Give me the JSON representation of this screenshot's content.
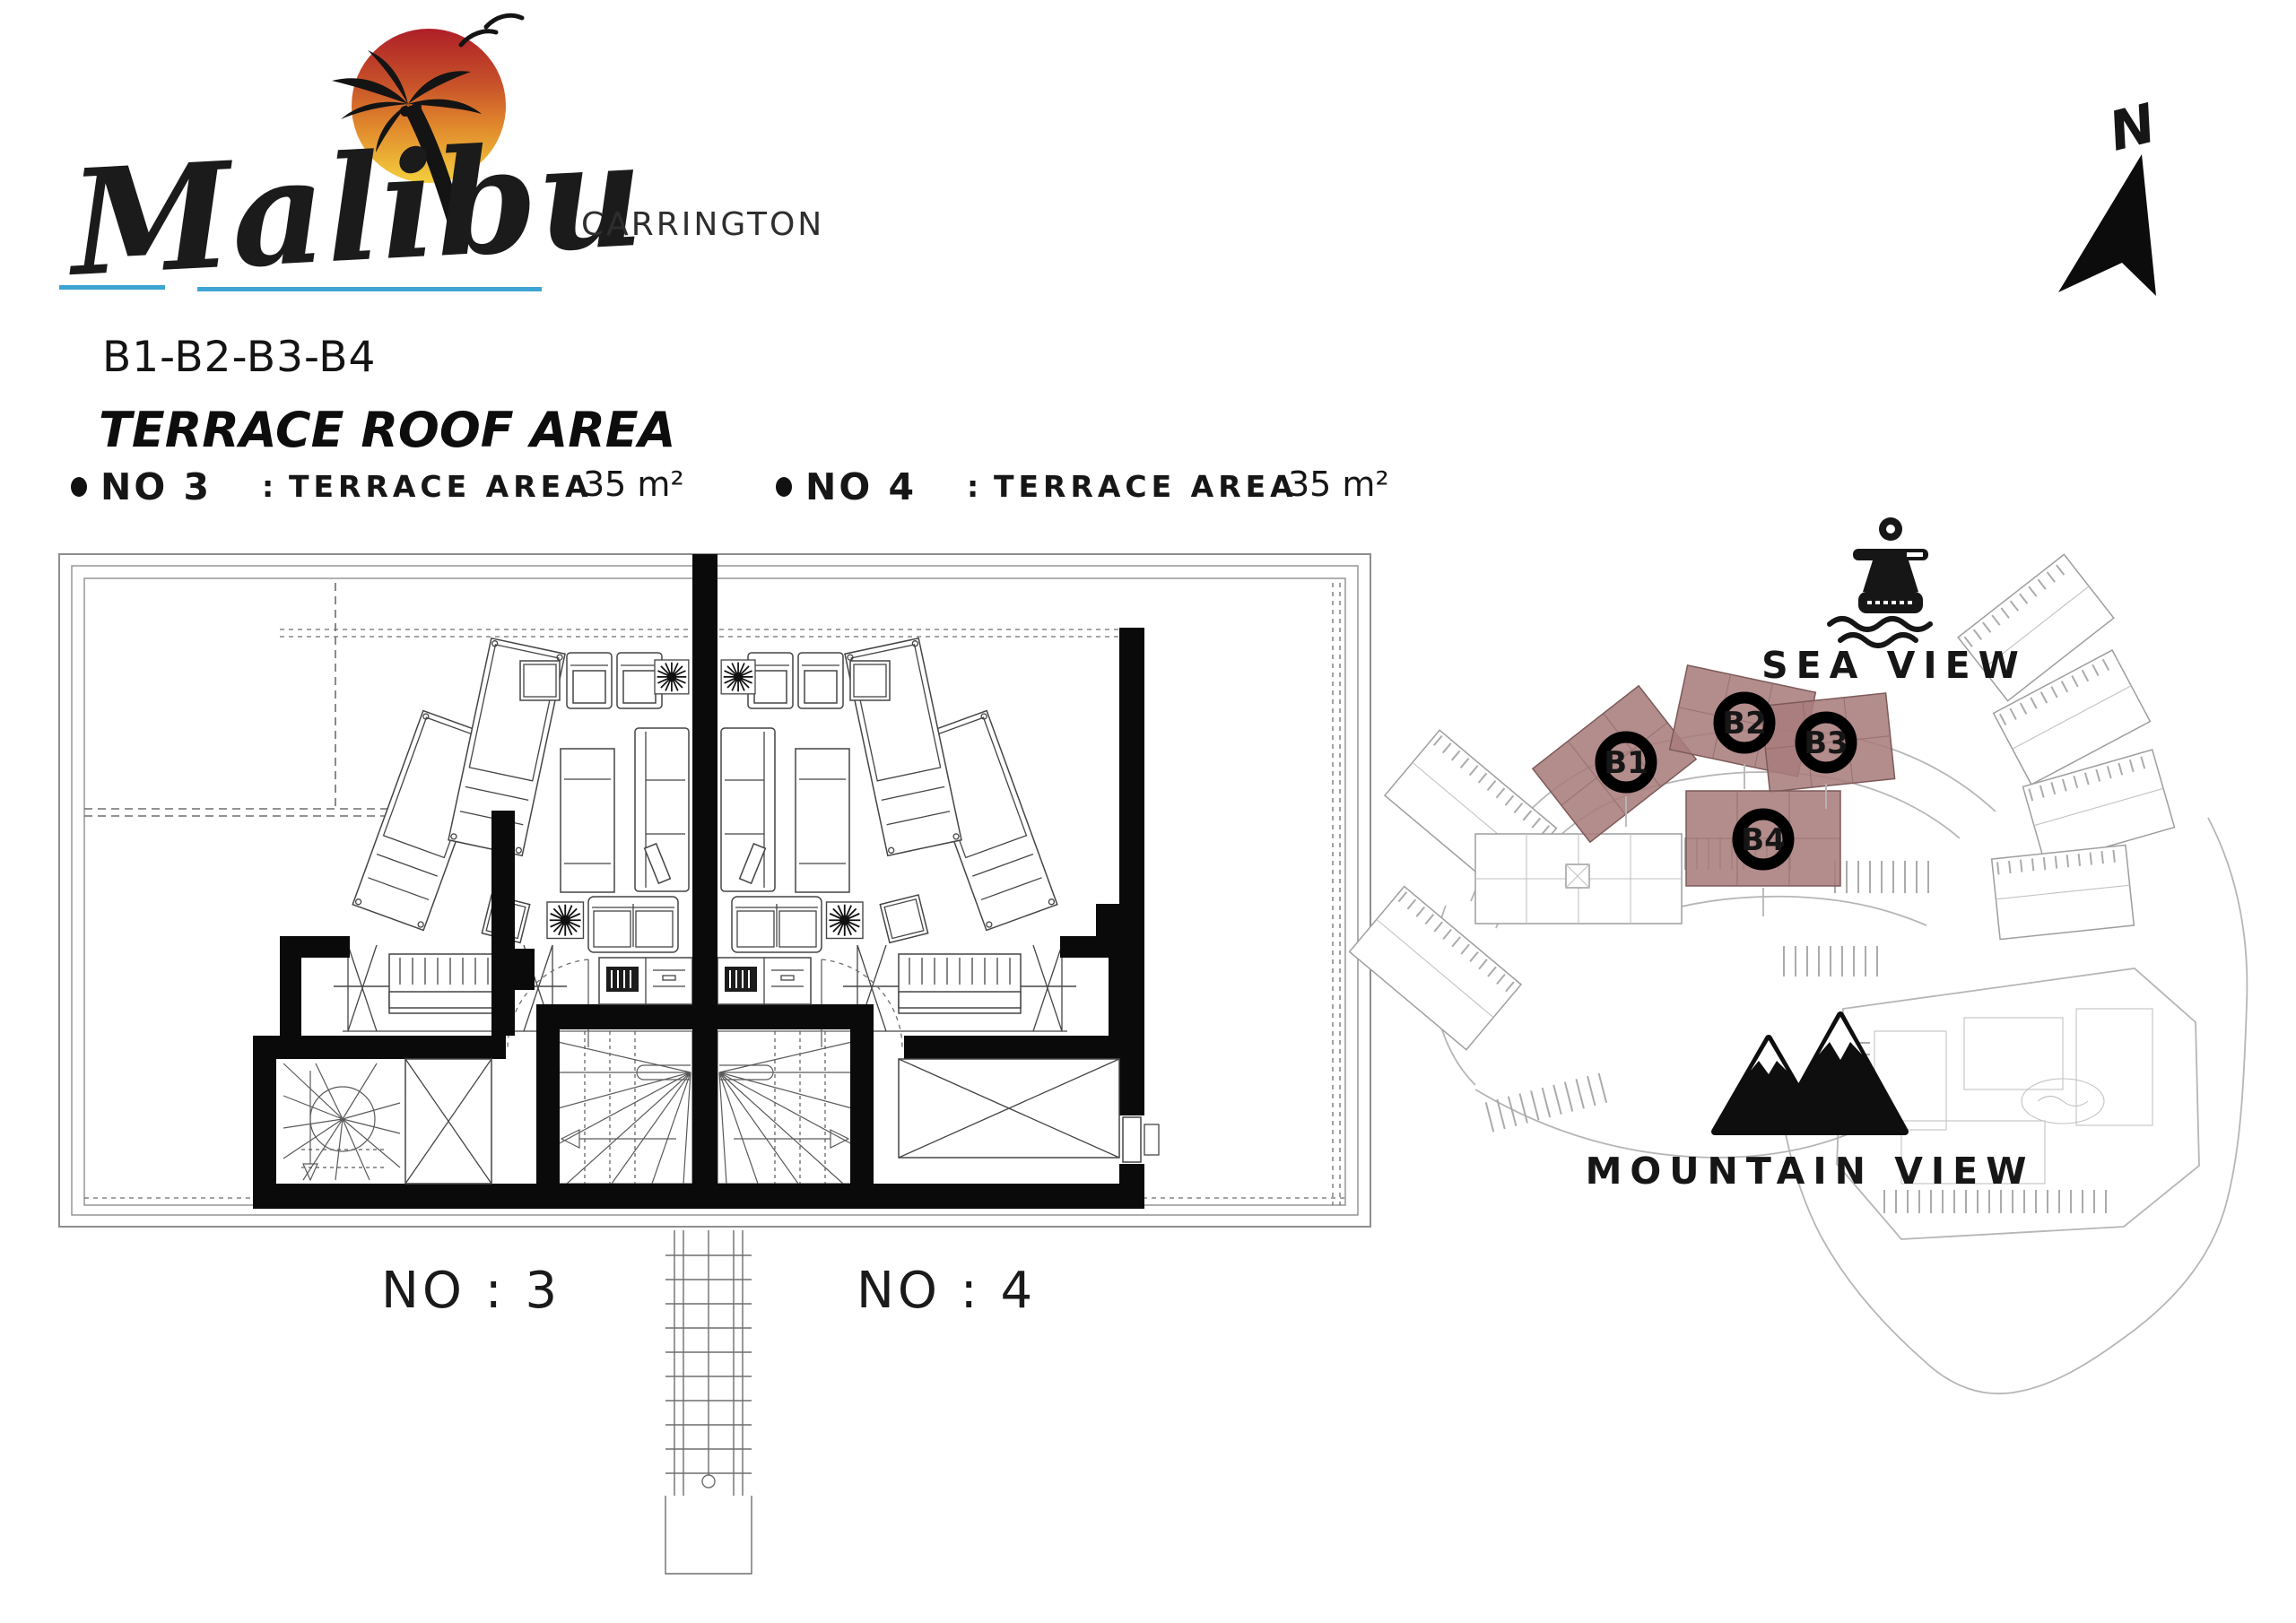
{
  "page": {
    "background": "#ffffff"
  },
  "logo": {
    "brand": "Malibu",
    "subtitle": "CARRINGTON",
    "sun_colors": {
      "top": "#ae1f27",
      "mid": "#e0862c",
      "bottom": "#f3cf3d"
    },
    "underline_color": "#3da4d4"
  },
  "header": {
    "unit_range": "B1-B2-B3-B4",
    "title": "TERRACE ROOF  AREA",
    "specs": [
      {
        "no": "NO 3",
        "colon": ":",
        "label": "TERRACE AREA",
        "value": "35 m²"
      },
      {
        "no": "NO 4",
        "colon": ":",
        "label": "TERRACE AREA",
        "value": "35 m²"
      }
    ]
  },
  "floor_plan": {
    "unit_labels": [
      "NO : 3",
      "NO : 4"
    ]
  },
  "site_map": {
    "north_label": "N",
    "sea_view_label": "SEA VIEW",
    "mountain_view_label": "MOUNTAIN VIEW",
    "highlight_color": "#a97c7c",
    "markers": [
      {
        "id": "B1"
      },
      {
        "id": "B2"
      },
      {
        "id": "B3"
      },
      {
        "id": "B4"
      }
    ]
  }
}
